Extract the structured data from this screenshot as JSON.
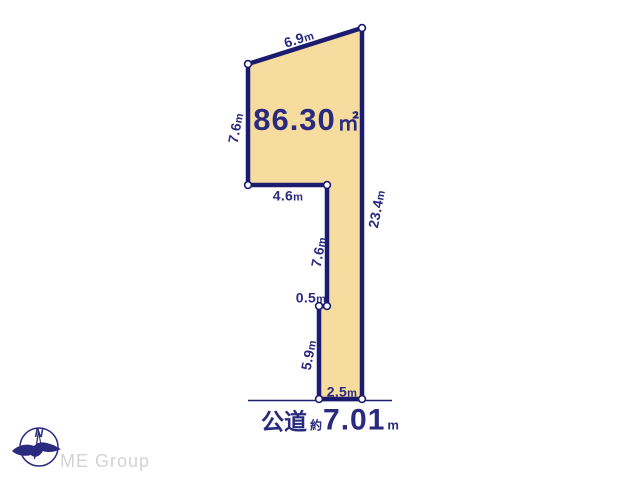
{
  "diagram": {
    "area": {
      "value": "86.30",
      "unit": "㎡"
    },
    "edges": {
      "top": {
        "value": "6.9",
        "unit": "m"
      },
      "left": {
        "value": "7.6",
        "unit": "m"
      },
      "inner_horizontal": {
        "value": "4.6",
        "unit": "m"
      },
      "right": {
        "value": "23.4",
        "unit": "m"
      },
      "inner_vertical": {
        "value": "7.6",
        "unit": "m"
      },
      "step": {
        "value": "0.5",
        "unit": "m"
      },
      "pole_left": {
        "value": "5.9",
        "unit": "m"
      },
      "bottom": {
        "value": "2.5",
        "unit": "m"
      }
    },
    "road": {
      "prefix": "公道",
      "approx": "約",
      "value": "7.01",
      "unit": "m"
    }
  },
  "branding": {
    "logo_text": "ME Group",
    "compass_label": "N"
  },
  "colors": {
    "plot_fill": "#f7dca0",
    "line_navy": "#1b1b70",
    "text_navy": "#2a2a7e",
    "logo_gray": "#d3d3d3",
    "background": "#ffffff"
  }
}
